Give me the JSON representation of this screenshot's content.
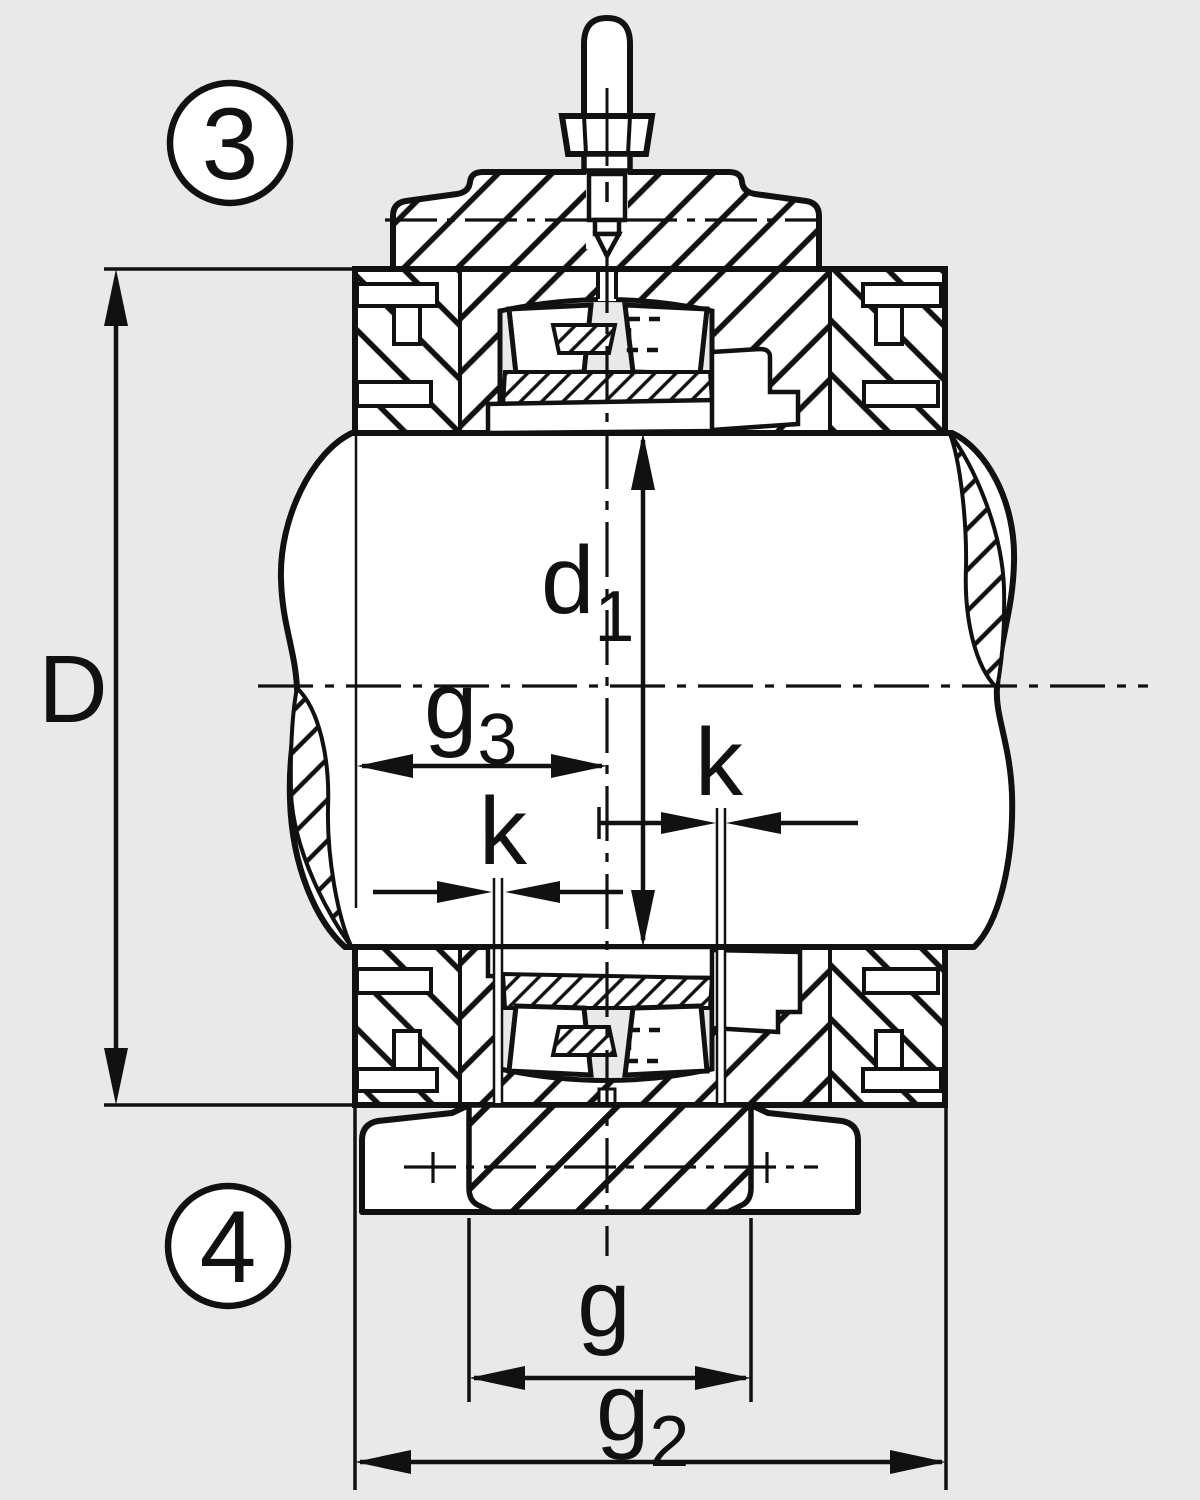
{
  "colors": {
    "background": "#e9e9e9",
    "ink": "#111111",
    "paper": "#ffffff"
  },
  "callouts": {
    "upper": "3",
    "lower": "4"
  },
  "dimensions": {
    "D": {
      "label": "D"
    },
    "d1": {
      "base": "d",
      "sub": "1"
    },
    "g3": {
      "base": "g",
      "sub": "3"
    },
    "k_left": {
      "label": "k"
    },
    "k_right": {
      "label": "k"
    },
    "g": {
      "label": "g"
    },
    "g2": {
      "base": "g",
      "sub": "2"
    }
  }
}
